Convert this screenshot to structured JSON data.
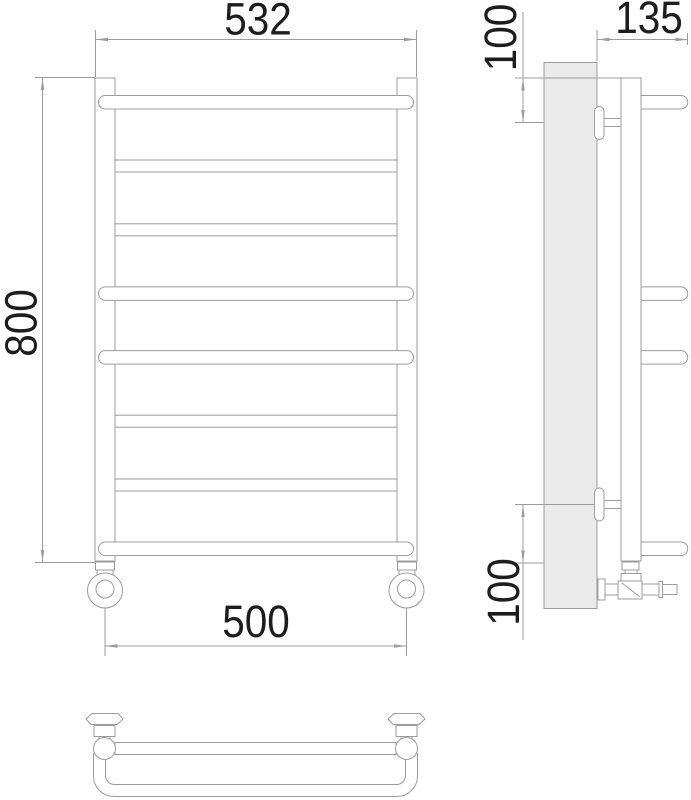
{
  "drawing": {
    "title": "towel-radiator-technical-drawing",
    "dimensions": {
      "overall_width": {
        "label": "532"
      },
      "overall_height": {
        "label": "800"
      },
      "connection_spacing": {
        "label": "500"
      },
      "depth": {
        "label": "135"
      },
      "top_bracket_offset": {
        "label": "100"
      },
      "bottom_bracket_offset": {
        "label": "100"
      }
    },
    "structure": {
      "rung_count": 8,
      "rung_pattern": [
        "curved",
        "straight",
        "straight",
        "curved",
        "curved",
        "straight",
        "straight",
        "curved"
      ],
      "bracket_count": 2,
      "views": [
        "front",
        "side",
        "plan"
      ]
    },
    "colors": {
      "line": "#9c9c9c",
      "wall_fill": "#eaeaea",
      "text": "#1d1d1d",
      "background": "#ffffff"
    }
  }
}
